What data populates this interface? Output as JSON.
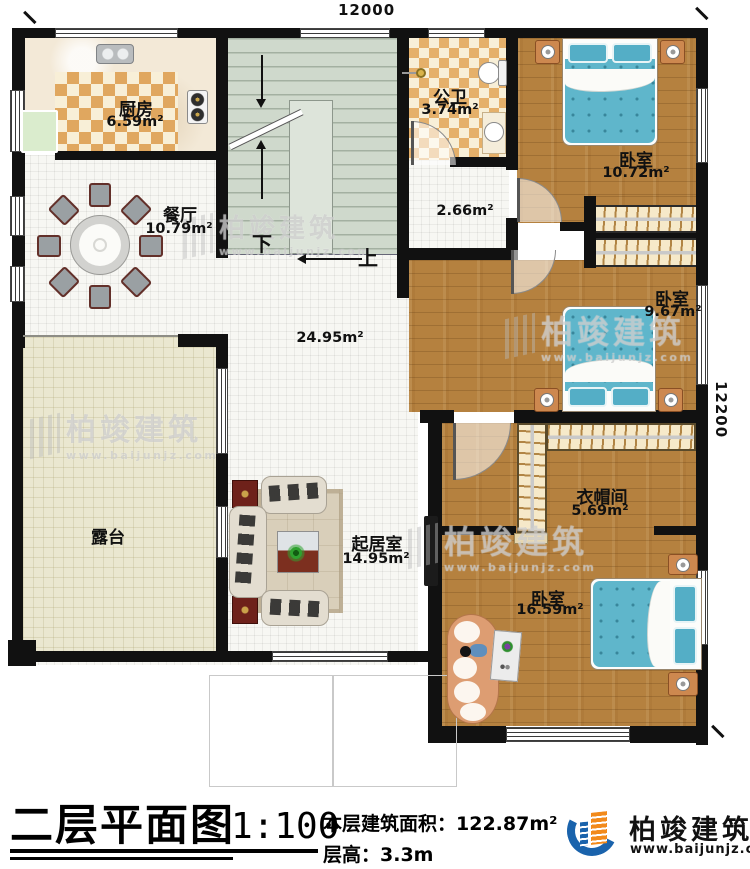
{
  "plan": {
    "dim_top": "12000",
    "dim_right": "12200",
    "stair_down": "下",
    "stair_up": "上",
    "rooms": {
      "kitchen": {
        "name": "厨房",
        "area": "6.59m²"
      },
      "bath": {
        "name": "公卫",
        "area": "3.74m²"
      },
      "bedroom1": {
        "name": "卧室",
        "area": "10.72m²"
      },
      "dining": {
        "name": "餐厅",
        "area": "10.79m²"
      },
      "hall": {
        "area": "2.66m²"
      },
      "open_area": {
        "area": "24.95m²"
      },
      "bedroom2": {
        "name": "卧室",
        "area": "9.67m²"
      },
      "terrace": {
        "name": "露台"
      },
      "living": {
        "name": "起居室",
        "area": "14.95m²"
      },
      "cloakroom": {
        "name": "衣帽间",
        "area": "5.69m²"
      },
      "bedroom3": {
        "name": "卧室",
        "area": "16.59m²"
      }
    }
  },
  "watermark": {
    "name": "柏竣建筑",
    "site": "www.baijunjz.com"
  },
  "title_block": {
    "title": "二层平面图",
    "scale": "1:100",
    "area_label": "本层建筑面积：",
    "area_value": "122.87m²",
    "height_label": "层高：",
    "height_value": "3.3m"
  },
  "logo": {
    "name": "柏竣建筑",
    "site": "www.baijunjz.com"
  },
  "colors": {
    "wall": "#111111",
    "wood_floor": "#b5813f",
    "bed": "#5fb6cb",
    "stair": "#cfd9cc",
    "terrace_floor": "#eae7d0",
    "check_tan": "#e0a75f",
    "logo_blue": "#1a63ac",
    "logo_orange": "#f28a1b"
  }
}
